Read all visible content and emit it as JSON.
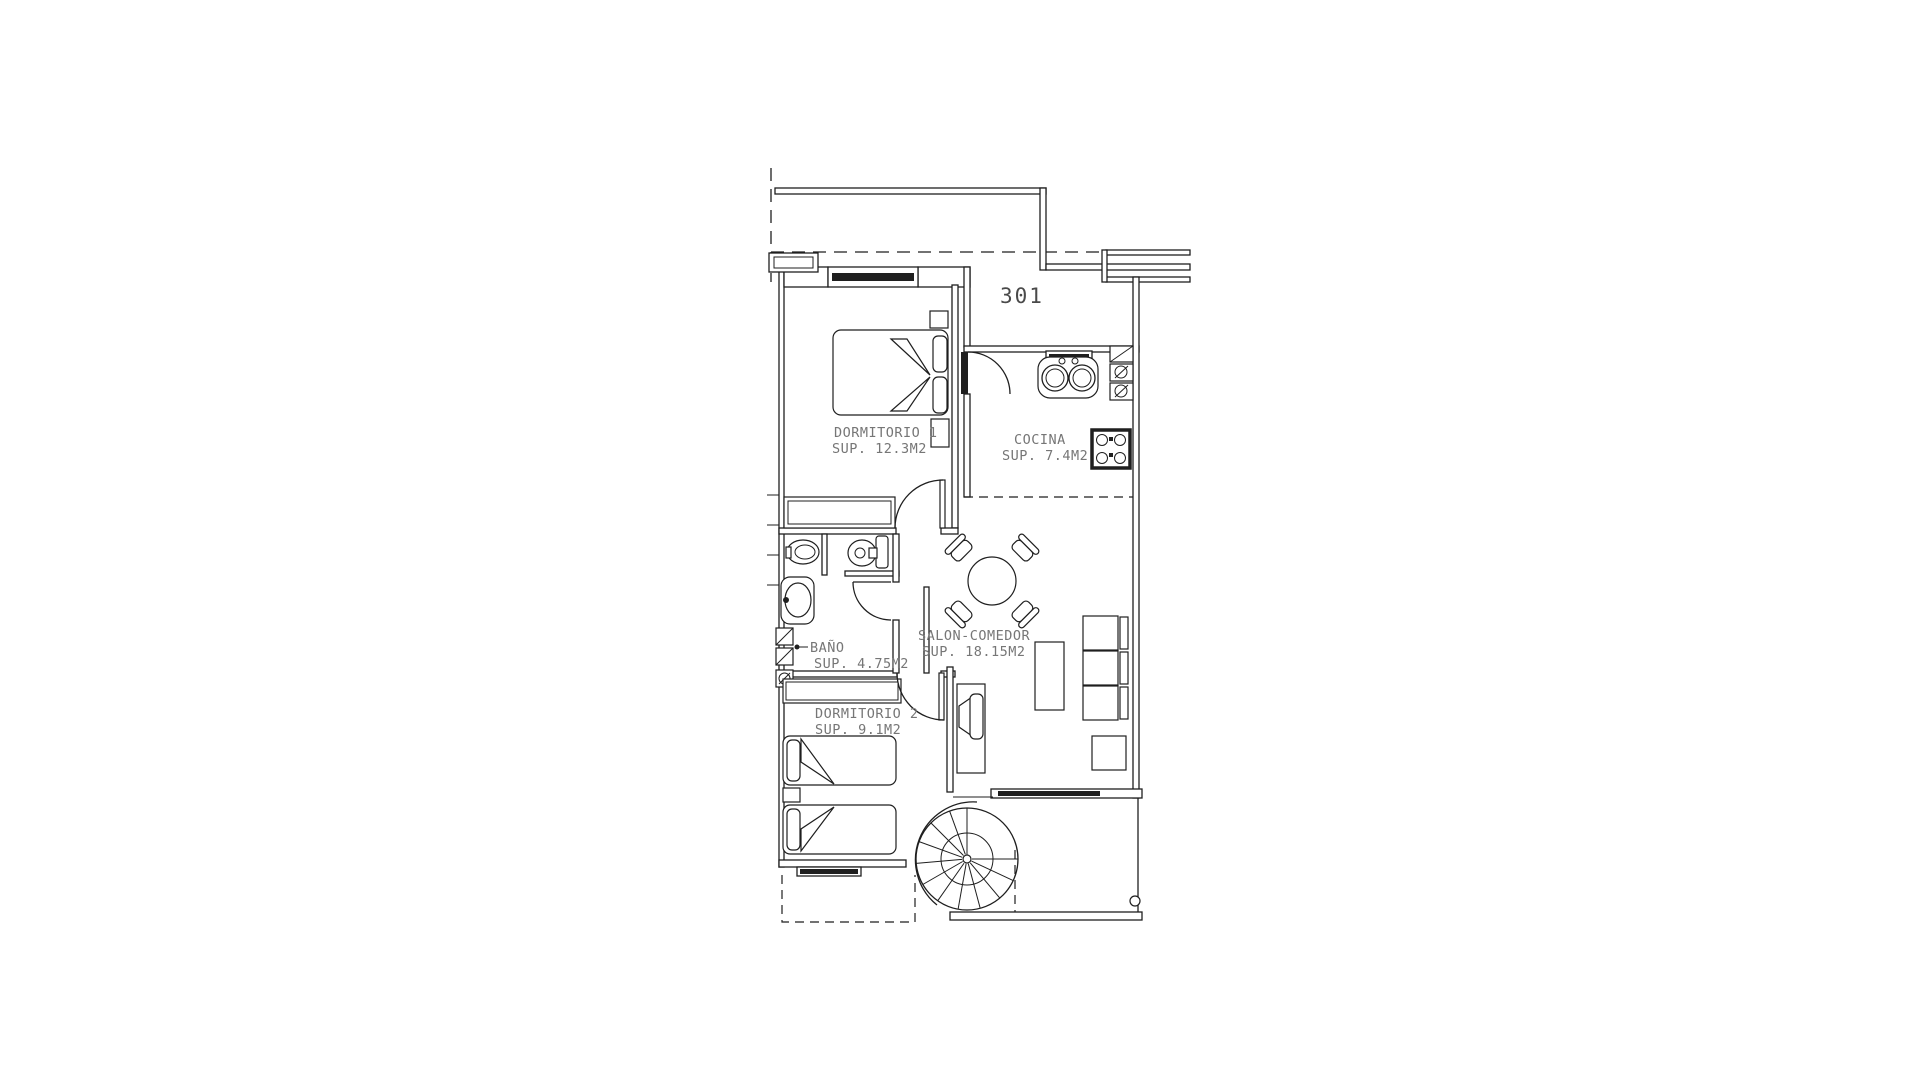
{
  "plan": {
    "unit_number": "301",
    "rooms": [
      {
        "name": "DORMITORIO 1",
        "area": "SUP. 12.3M2"
      },
      {
        "name": "COCINA",
        "area": "SUP. 7.4M2"
      },
      {
        "name": "BAÑO",
        "area": "SUP. 4.75M2"
      },
      {
        "name": "SALON-COMEDOR",
        "area": "SUP. 18.15M2"
      },
      {
        "name": "DORMITORIO 2",
        "area": "SUP. 9.1M2"
      }
    ],
    "colors": {
      "line": "#1f1f1f",
      "label": "#767676",
      "background": "#ffffff"
    }
  }
}
